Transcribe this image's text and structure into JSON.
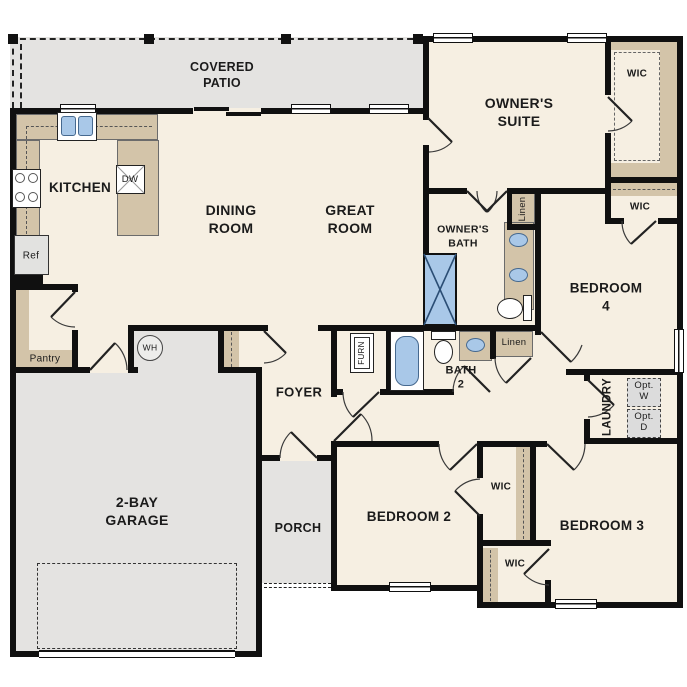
{
  "floor_plan": {
    "rooms": {
      "covered_patio": "COVERED\nPATIO",
      "kitchen": "KITCHEN",
      "dining_room": "DINING\nROOM",
      "great_room": "GREAT\nROOM",
      "owners_suite": "OWNER'S\nSUITE",
      "owners_bath": "OWNER'S\nBATH",
      "bath_2": "BATH\n2",
      "bedroom_2": "BEDROOM 2",
      "bedroom_3": "BEDROOM 3",
      "bedroom_4": "BEDROOM 4",
      "foyer": "FOYER",
      "porch": "PORCH",
      "garage": "2-BAY\nGARAGE",
      "laundry": "LAUNDRY",
      "pantry": "Pantry",
      "wic": "WIC",
      "linen": "Linen"
    },
    "fixtures": {
      "refrigerator": "Ref",
      "dishwasher": "DW",
      "water_heater": "WH",
      "furnace": "FURN",
      "optional_washer": "Opt.\nW",
      "optional_dryer": "Opt.\nD"
    },
    "colors": {
      "floor": "#f6efe2",
      "outdoor": "#e4e3e1",
      "casework": "#d3c4a9",
      "fixture_blue": "#a9c8e8",
      "walls": "#101010"
    }
  }
}
